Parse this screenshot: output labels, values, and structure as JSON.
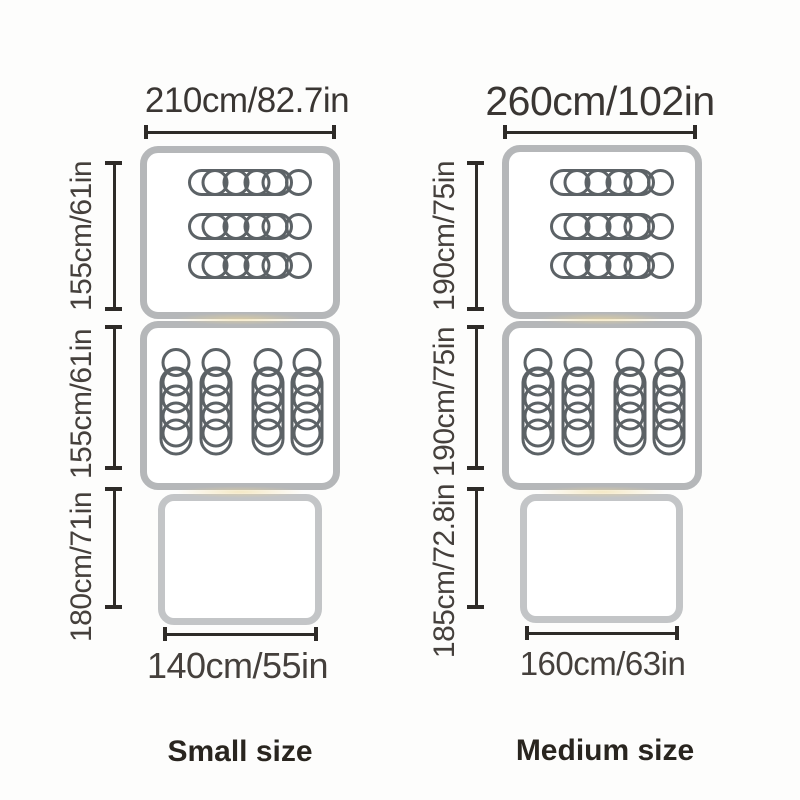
{
  "page": {
    "background": "#fdfdfc"
  },
  "colors": {
    "room_border": "#b5b7b9",
    "vestibule_border": "#c3c5c7",
    "icon_stroke": "#5c6266",
    "dimension_line": "#2e2b28",
    "dimension_text": "#45403c",
    "size_label_text": "#29251f"
  },
  "icons": {
    "sleeping_pad": "sleeping-pad-icon",
    "sleeping_bag": "sleeping-bag-icon"
  },
  "diagrams": [
    {
      "size_label": "Small size",
      "top_width_label": "210cm/82.7in",
      "bottom_width_label": "140cm/55in",
      "side_labels": [
        "155cm/61in",
        "155cm/61in",
        "180cm/71in"
      ],
      "top_room_pad_count": 3,
      "middle_room_bag_count": 4
    },
    {
      "size_label": "Medium size",
      "top_width_label": "260cm/102in",
      "bottom_width_label": "160cm/63in",
      "side_labels": [
        "190cm/75in",
        "190cm/75in",
        "185cm/72.8in"
      ],
      "top_room_pad_count": 3,
      "middle_room_bag_count": 4
    }
  ]
}
